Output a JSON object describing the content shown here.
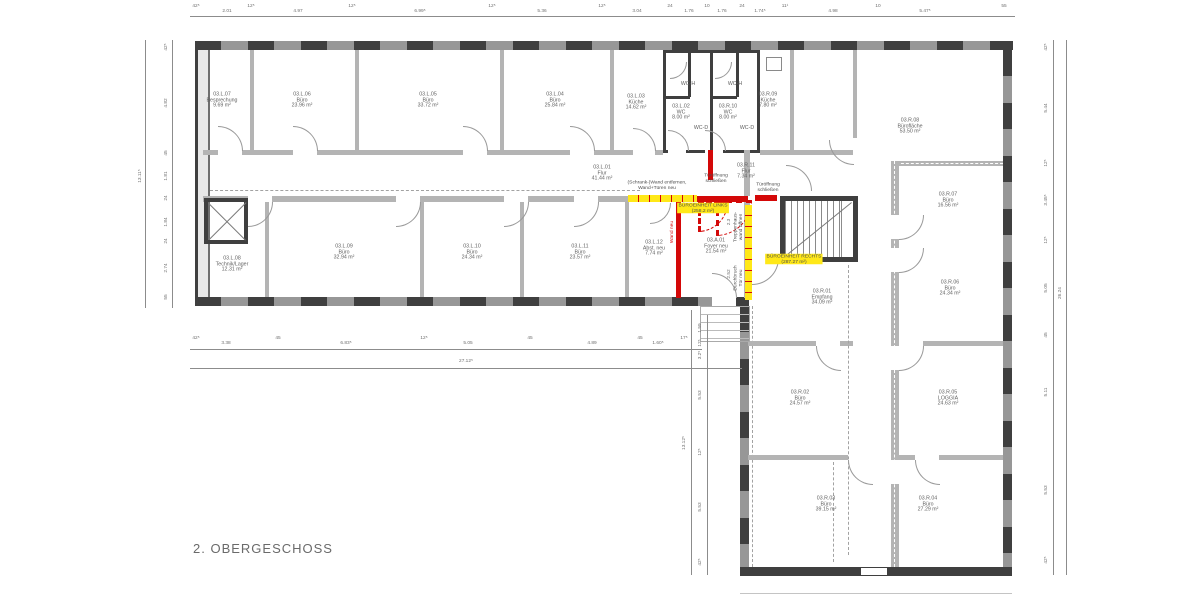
{
  "title": "2. OBERGESCHOSS",
  "colors": {
    "new_wall_red": "#d40808",
    "highlight_yellow": "#ffe818",
    "wall_dark": "#3f3f3f"
  },
  "rooms": [
    {
      "id": "03.L.07",
      "name": "Besprechung",
      "area": "9.69 m²"
    },
    {
      "id": "03.L.06",
      "name": "Büro",
      "area": "23.96 m²"
    },
    {
      "id": "03.L.05",
      "name": "Büro",
      "area": "33.72 m²"
    },
    {
      "id": "03.L.04",
      "name": "Büro",
      "area": "25.84 m²"
    },
    {
      "id": "03.L.03",
      "name": "Küche",
      "area": "14.62 m²"
    },
    {
      "id": "03.L.02",
      "name": "WC",
      "area": "8.00 m²"
    },
    {
      "id": "03.R.10",
      "name": "WC",
      "area": "8.00 m²"
    },
    {
      "id": "03.R.09",
      "name": "Küche",
      "area": "7.80 m²"
    },
    {
      "id": "03.R.08",
      "name": "Bürofläche",
      "area": "53.50 m²"
    },
    {
      "id": "03.L.01",
      "name": "Flur",
      "area": "41.44 m²"
    },
    {
      "id": "03.R.11",
      "name": "Flur",
      "area": "7.34 m²"
    },
    {
      "id": "03.L.08",
      "name": "Technik/Lager",
      "area": "12.31 m²"
    },
    {
      "id": "03.L.09",
      "name": "Büro",
      "area": "32.94 m²"
    },
    {
      "id": "03.L.10",
      "name": "Büro",
      "area": "24.34 m²"
    },
    {
      "id": "03.L.11",
      "name": "Büro",
      "area": "23.57 m²"
    },
    {
      "id": "03.L.12",
      "name": "Abst. neu",
      "area": "7.74 m²"
    },
    {
      "id": "03.A.01",
      "name": "Foyer neu",
      "area": "21.54 m²"
    },
    {
      "id": "03.R.01",
      "name": "Empfang",
      "area": "34.09 m²"
    },
    {
      "id": "03.R.07",
      "name": "Büro",
      "area": "16.56 m²"
    },
    {
      "id": "03.R.06",
      "name": "Büro",
      "area": "24.34 m²"
    },
    {
      "id": "03.R.02",
      "name": "Büro",
      "area": "24.57 m²"
    },
    {
      "id": "03.R.05",
      "name": "LOGGIA",
      "area": "24.63 m²"
    },
    {
      "id": "03.R.03",
      "name": "Büro",
      "area": "39.15 m²"
    },
    {
      "id": "03.R.04",
      "name": "Büro",
      "area": "27.29 m²"
    }
  ],
  "wc": {
    "h1": "WC-H",
    "h2": "WC-H",
    "d1": "WC-D",
    "d2": "WC-D"
  },
  "annotations": {
    "schrank_wand": "(Schrank-)Wand entfernen,\nWand+Türen neu",
    "tueroeffnung_links": "Türöffnung\nschließen",
    "tueroeffnung_rechts": "Türöffnung\nschließen",
    "einheit_links": "BÜROEINHEIT LINKS\n(258.2 m²)",
    "einheit_rechts": "BÜROEINHEIT RECHTS\n(287.27 m²)",
    "wand_neu": "Wand neu",
    "treppenhauswand": "Treppenhaus-\nwand öffnen",
    "durchbruch": "Durchbruch\nTür neu"
  },
  "dims": {
    "top": [
      "42⁵",
      "2.01",
      "12⁵",
      "4.97",
      "12⁵",
      "6.99⁵",
      "12⁵",
      "5.36",
      "12⁵",
      "3.04",
      "24",
      "1.76",
      "10",
      "1.76",
      "24",
      "1.74⁵",
      "11¹",
      "4.98",
      "10",
      "5.47⁵",
      "55"
    ],
    "left": [
      "42⁵",
      "4.82",
      "45",
      "1.81",
      "24",
      "1.84",
      "24",
      "2.74",
      "55"
    ],
    "left_total": "13.11⁵",
    "bottom": [
      "42⁵",
      "3.38",
      "45",
      "6.83⁵",
      "12⁵",
      "5.05",
      "45",
      "4.89",
      "45",
      "1.60⁵",
      "17⁵"
    ],
    "bottom_total": "27.12⁵",
    "right": [
      "42⁵",
      "5.44",
      "12⁵",
      "3.45⁵",
      "12⁵",
      "5.05",
      "45",
      "5.11",
      "5.53",
      "42⁵"
    ],
    "right_total": "26.24",
    "center": [
      "1.59",
      "12⁵",
      "3.2⁵",
      "5.53",
      "12⁵",
      "5.53",
      "42⁵"
    ],
    "center_total": "13.12⁵",
    "foyer": [
      "2.3",
      "2.52"
    ]
  }
}
